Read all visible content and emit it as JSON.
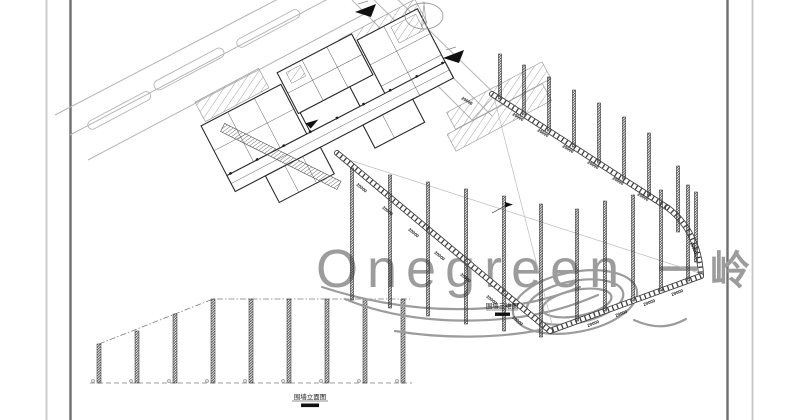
{
  "watermark": {
    "brand": "Onegreen",
    "brand_cjk": "一岭",
    "color": "#9c9c9c"
  },
  "labels": {
    "axon_title": "围墙三维图",
    "elevation_title": "围墙立面图",
    "dimension": "20000",
    "north": "N"
  },
  "colors": {
    "background": "#ffffff",
    "cad_line": "#2a2a2a",
    "road_line": "#b5b5b5",
    "border_dark": "#6f6f6f",
    "border_light": "#cccccc",
    "watermark": "#9c9c9c"
  }
}
